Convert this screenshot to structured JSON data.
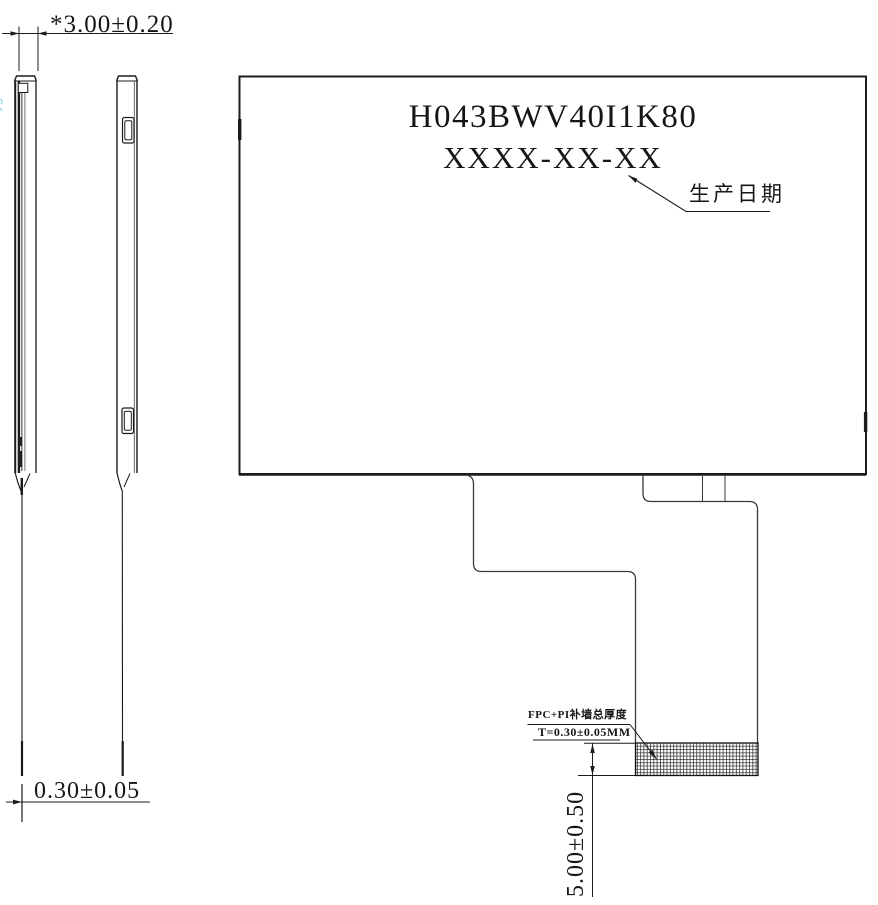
{
  "colors": {
    "ink": "#1b1b1b",
    "thin_line": "#4a4a4a",
    "edge_artifact_cyan": "#8ed3e0",
    "background": "#ffffff"
  },
  "back_view": {
    "part_number": "H043BWV40I1K80",
    "date_code": "XXXX-XX-XX",
    "date_label": "生产日期"
  },
  "dimensions": {
    "module_thickness": "*3.00±0.20",
    "fpc_thickness": "0.30±0.05",
    "stiffener_height": "5.00±0.50"
  },
  "fpc_note": {
    "line1": "FPC+PI补墙总厚度",
    "line2": "T=0.30±0.05MM"
  }
}
